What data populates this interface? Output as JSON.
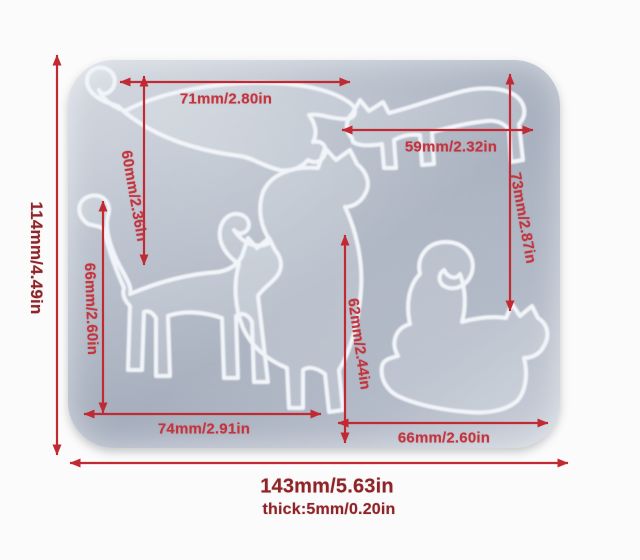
{
  "scene": {
    "title": "Cat silicone mold dimension diagram",
    "colors": {
      "background": "#fbfbfb",
      "mold_surface": "#aab2c0",
      "mold_highlight": "#d2d7e0",
      "cavity_outline": "#f1f4f8",
      "dimension_line": "#c22a33",
      "inner_label": "#c2353e",
      "outer_label": "#8e2427"
    },
    "cat_cavities": [
      "lying-stretch-cat-top-left",
      "play-bow-cat-top-right",
      "standing-cat-center",
      "walking-cat-bottom-left",
      "crouching-cat-bottom-right"
    ]
  },
  "dimensions": {
    "overall_height": "114mm/4.49in",
    "overall_width": "143mm/5.63in",
    "thickness": "thick:5mm/0.20in",
    "top_left_width": "71mm/2.80in",
    "top_left_height": "60mm/2.36in",
    "top_right_width": "59mm/2.32in",
    "top_right_height": "73mm/2.87in",
    "middle_left_height": "66mm/2.60in",
    "center_height": "62mm/2.44in",
    "bottom_left_width": "74mm/2.91in",
    "bottom_right_width": "66mm/2.60in"
  }
}
